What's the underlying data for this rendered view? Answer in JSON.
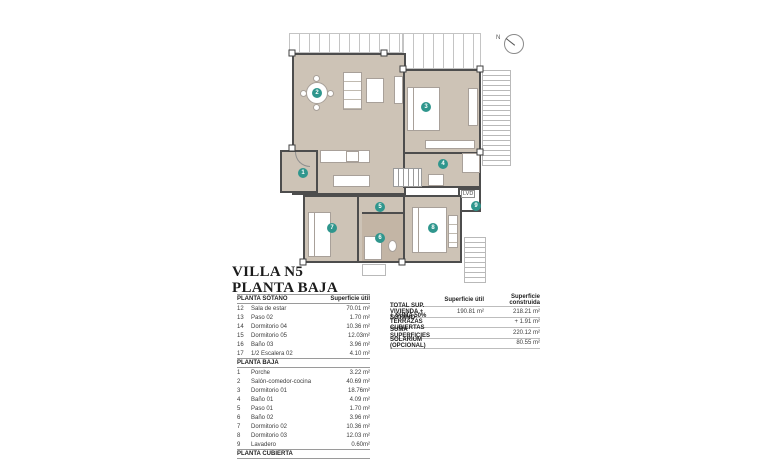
{
  "title": {
    "line1": "VILLA N5",
    "line2": "PLANTA BAJA"
  },
  "colors": {
    "accent_teal": "#2f968d",
    "floor_beige": "#cdc3b6",
    "wall_gray": "#4d4d4d"
  },
  "plan": {
    "north_label": "N",
    "lvd_label": "LVD",
    "markers": [
      {
        "num": "1"
      },
      {
        "num": "2"
      },
      {
        "num": "3"
      },
      {
        "num": "4"
      },
      {
        "num": "5"
      },
      {
        "num": "6"
      },
      {
        "num": "7"
      },
      {
        "num": "8"
      },
      {
        "num": "9"
      }
    ]
  },
  "tables": {
    "sotano": {
      "header": "PLANTA SÓTANO",
      "col": "Superficie útil",
      "rows": [
        {
          "num": "12",
          "name": "Sala de estar",
          "value": "70.01 m²"
        },
        {
          "num": "13",
          "name": "Paso 02",
          "value": "1.70 m²"
        },
        {
          "num": "14",
          "name": "Dormitorio 04",
          "value": "10.36 m²"
        },
        {
          "num": "15",
          "name": "Dormitorio 05",
          "value": "12.03m²"
        },
        {
          "num": "16",
          "name": "Baño 03",
          "value": "3.96 m²"
        },
        {
          "num": "17",
          "name": "1/2 Escalera 02",
          "value": "4.10 m²"
        }
      ]
    },
    "baja": {
      "header": "PLANTA BAJA",
      "rows": [
        {
          "num": "1",
          "name": "Porche",
          "value": "3.22 m²"
        },
        {
          "num": "2",
          "name": "Salón-comedor-cocina",
          "value": "40.69 m²"
        },
        {
          "num": "3",
          "name": "Dormitorio 01",
          "value": "18.76m²"
        },
        {
          "num": "4",
          "name": "Baño 01",
          "value": "4.09 m²"
        },
        {
          "num": "5",
          "name": "Paso 01",
          "value": "1.70 m²"
        },
        {
          "num": "6",
          "name": "Baño 02",
          "value": "3.96 m²"
        },
        {
          "num": "7",
          "name": "Dormitorio 02",
          "value": "10.36 m²"
        },
        {
          "num": "8",
          "name": "Dormitorio 03",
          "value": "12.03 m²"
        },
        {
          "num": "9",
          "name": "Lavadero",
          "value": "0.60m²"
        }
      ]
    },
    "cubierta": {
      "header": "PLANTA CUBIERTA"
    },
    "summary": {
      "col_util": "Superficie útil",
      "col_cons": "Superficie construida",
      "rows": [
        {
          "label": "TOTAL SUP. VIVIENDA + SÓTANO",
          "util": "190.81 m²",
          "cons": "218.21 m²"
        },
        {
          "label": "+ SUMA 50% TERRAZAS CUBIERTAS",
          "util": "",
          "cons": "+ 1.91 m²"
        },
        {
          "label": "SUMA SUPERFICIES",
          "util": "",
          "cons": "220.12 m²"
        },
        {
          "label": "SOLARIUM (OPCIONAL)",
          "util": "",
          "cons": "80.55 m²"
        }
      ]
    }
  }
}
